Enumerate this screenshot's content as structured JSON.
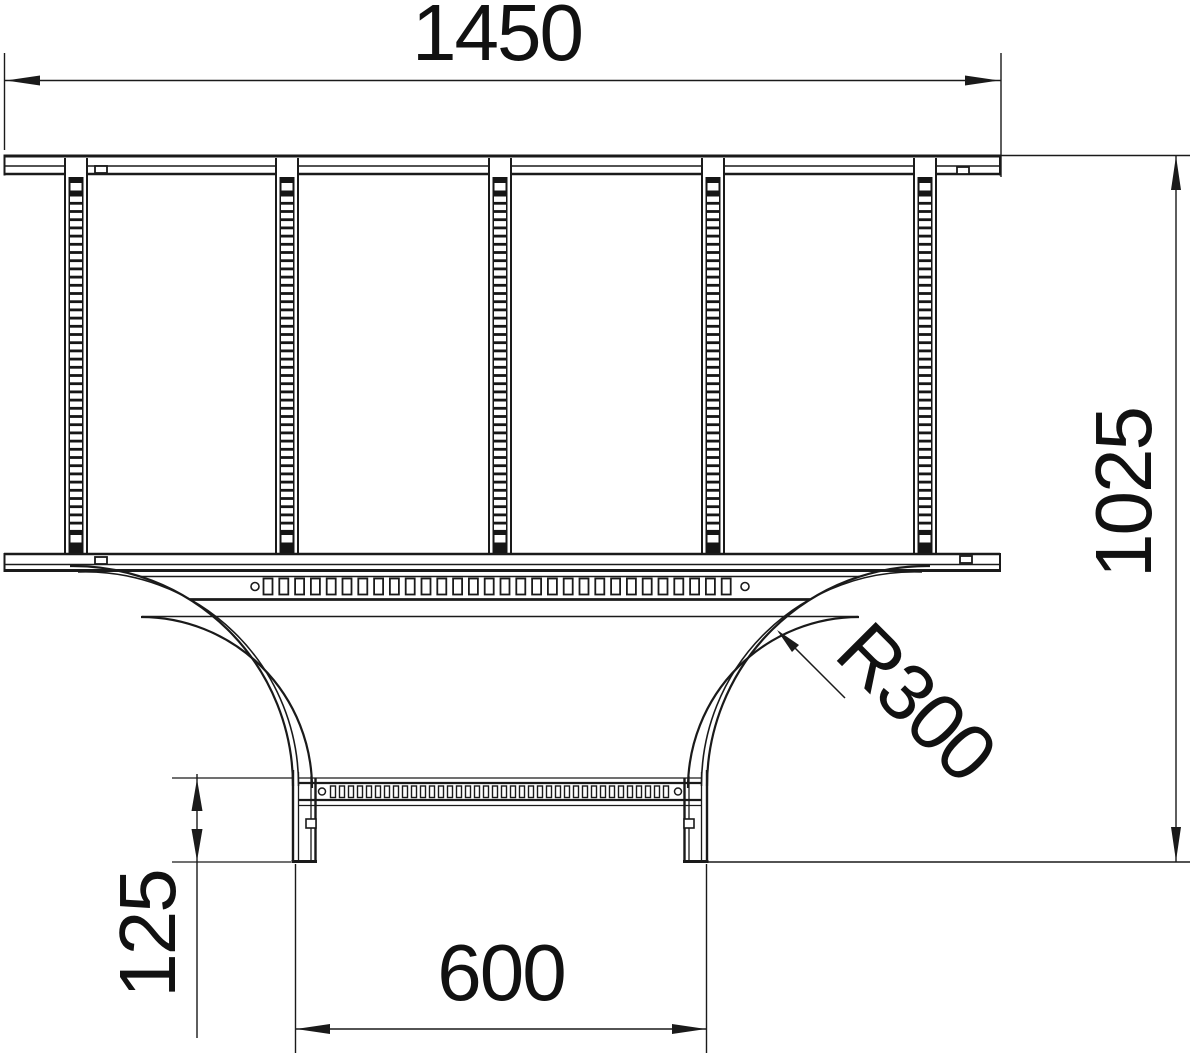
{
  "labels": {
    "width_top": "1450",
    "height_right": "1025",
    "radius": "R300",
    "rung_offset": "125",
    "width_bottom": "600"
  }
}
